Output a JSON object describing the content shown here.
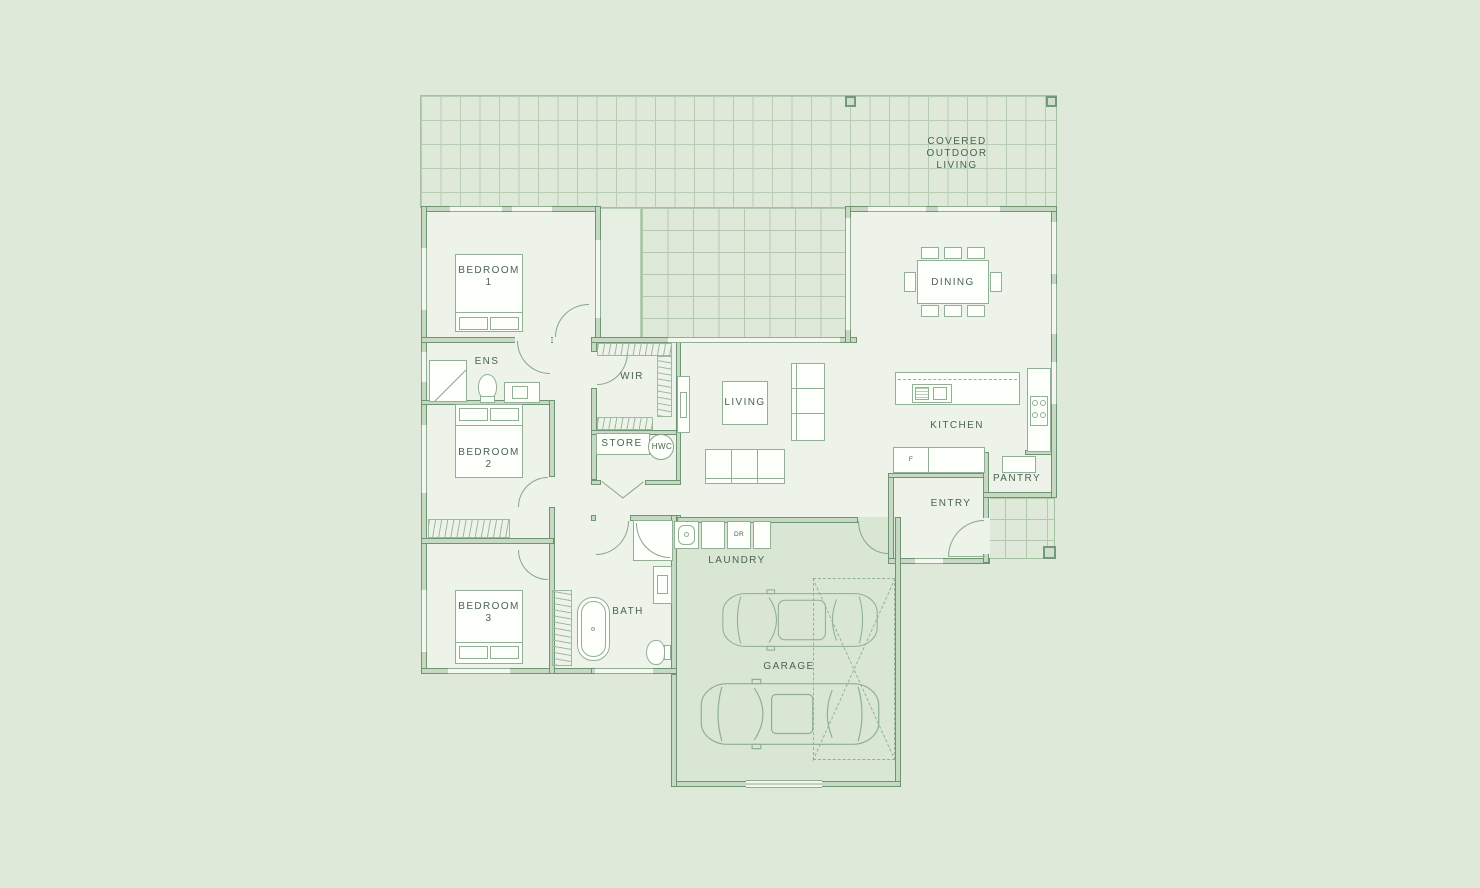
{
  "labels": {
    "covered_outdoor_living": "COVERED\nOUTDOOR\nLIVING",
    "bedroom1": "BEDROOM\n1",
    "ens": "ENS",
    "wir": "WIR",
    "bedroom2": "BEDROOM\n2",
    "store": "STORE",
    "hwc": "HWC",
    "living": "LIVING",
    "dining": "DINING",
    "kitchen": "KITCHEN",
    "pantry": "PANTRY",
    "entry": "ENTRY",
    "bedroom3": "BEDROOM\n3",
    "bath": "BATH",
    "laundry": "LAUNDRY",
    "garage": "GARAGE",
    "dryer_abbrev": "DR",
    "fridge_abbrev": "F"
  },
  "colors": {
    "page_background": "#dee9da",
    "room_fill": "#edf3e9",
    "garage_fill": "#d9e6d3",
    "wall_fill": "#c7d9c2",
    "wall_edge": "#6e9573",
    "furniture_line": "#92b095",
    "deck_grid": "#b2c9ae",
    "text": "#4b6354"
  }
}
